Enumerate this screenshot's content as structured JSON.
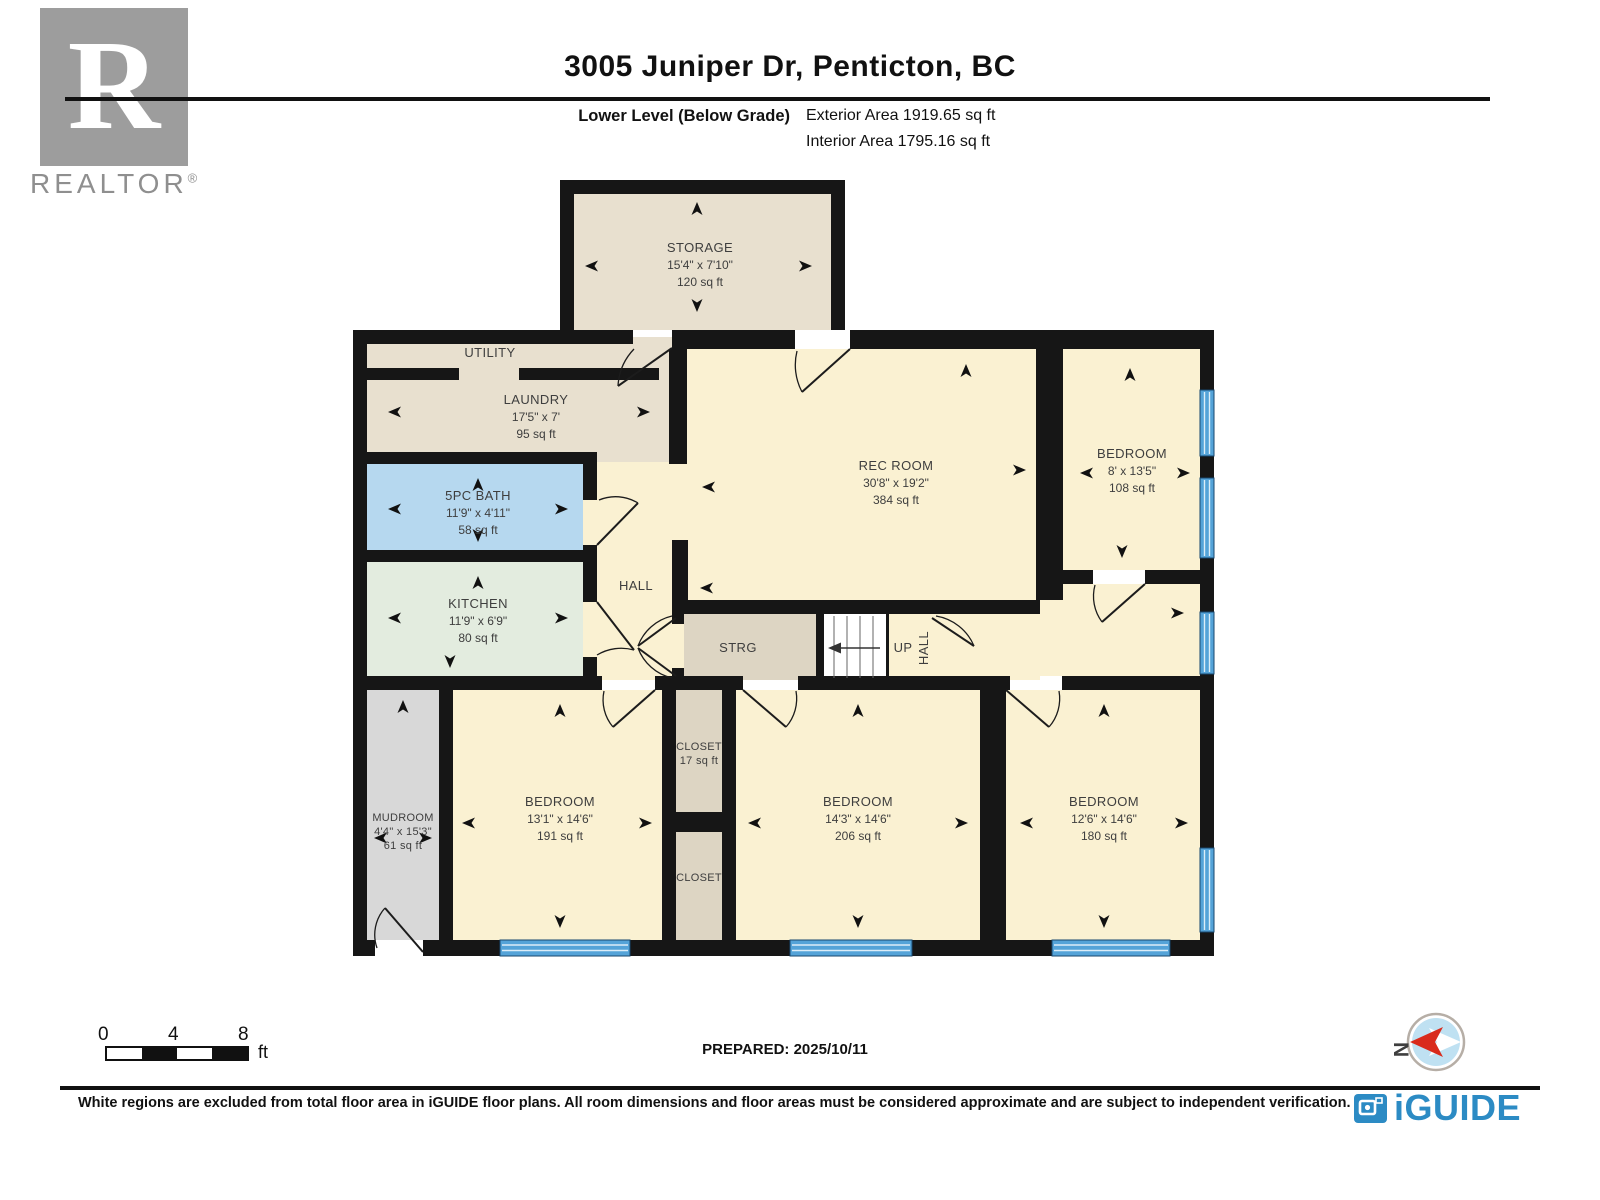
{
  "header": {
    "title": "3005 Juniper Dr, Penticton, BC",
    "level_label": "Lower Level (Below Grade)",
    "exterior_area": "Exterior Area 1919.65 sq ft",
    "interior_area": "Interior Area 1795.16 sq ft"
  },
  "branding": {
    "realtor_monogram": "R",
    "realtor_wordmark": "REALTOR",
    "registered_symbol": "®",
    "iguide_wordmark": "iGUIDE"
  },
  "rooms": {
    "storage": {
      "name": "STORAGE",
      "dims": "15'4\" x 7'10\"",
      "area": "120 sq ft"
    },
    "utility": {
      "name": "UTILITY"
    },
    "laundry": {
      "name": "LAUNDRY",
      "dims": "17'5\" x 7'",
      "area": "95 sq ft"
    },
    "bath": {
      "name": "5PC BATH",
      "dims": "11'9\" x 4'11\"",
      "area": "58 sq ft"
    },
    "kitchen": {
      "name": "KITCHEN",
      "dims": "11'9\" x 6'9\"",
      "area": "80 sq ft"
    },
    "hall": {
      "name": "HALL"
    },
    "hall_stairs": {
      "name": "HALL"
    },
    "rec_room": {
      "name": "REC ROOM",
      "dims": "30'8\" x 19'2\"",
      "area": "384 sq ft"
    },
    "strg": {
      "name": "STRG"
    },
    "bedroom_ne": {
      "name": "BEDROOM",
      "dims": "8' x 13'5\"",
      "area": "108 sq ft"
    },
    "mudroom": {
      "name": "MUDROOM",
      "dims": "4'4\" x 15'3\"",
      "area": "61 sq ft"
    },
    "bedroom_sw": {
      "name": "BEDROOM",
      "dims": "13'1\" x 14'6\"",
      "area": "191 sq ft"
    },
    "closet_upper": {
      "name": "CLOSET",
      "area": "17 sq ft"
    },
    "closet_lower": {
      "name": "CLOSET"
    },
    "bedroom_s": {
      "name": "BEDROOM",
      "dims": "14'3\" x 14'6\"",
      "area": "206 sq ft"
    },
    "bedroom_se": {
      "name": "BEDROOM",
      "dims": "12'6\" x 14'6\"",
      "area": "180 sq ft"
    }
  },
  "stairs": {
    "up_label": "UP"
  },
  "scale_bar": {
    "ticks": [
      "0",
      "4",
      "8"
    ],
    "unit": "ft"
  },
  "compass": {
    "north_label": "N"
  },
  "footer": {
    "prepared_label": "PREPARED: 2025/10/11",
    "disclaimer": "White regions are excluded from total floor area in iGUIDE floor plans. All room dimensions and floor areas must be considered approximate and are subject to independent verification."
  },
  "colors": {
    "wall": "#161616",
    "room_cream": "#faf1d2",
    "room_beige": "#e8e0cf",
    "room_tan": "#ddd5c3",
    "room_grey": "#d8d8d8",
    "bath_blue": "#b6d8ef",
    "kitchen_green": "#e3ecdf",
    "window_blue": "#54a3d8",
    "iguide_blue": "#2c8bc4",
    "compass_red": "#d92b1c",
    "realtor_grey": "#9d9d9d"
  }
}
